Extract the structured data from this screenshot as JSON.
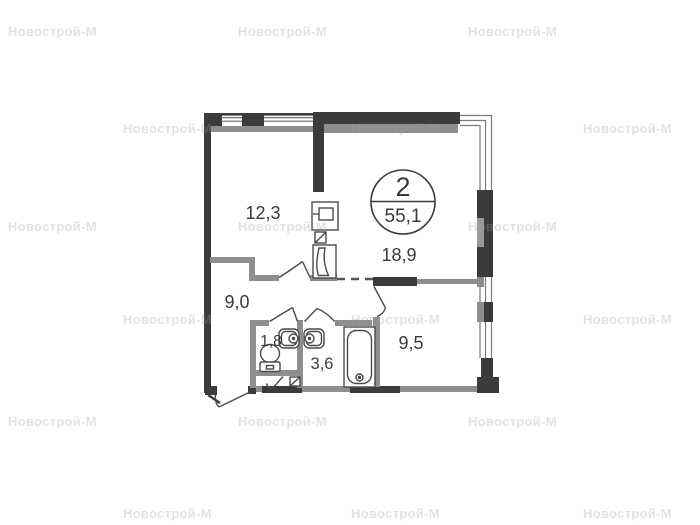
{
  "watermark": {
    "text": "Новострой-М"
  },
  "badge": {
    "rooms_count": "2",
    "total_area": "55,1"
  },
  "rooms": {
    "room1": {
      "label": "12,3"
    },
    "living": {
      "label": "18,9"
    },
    "hall": {
      "label": "9,0"
    },
    "wc": {
      "label": "1,8"
    },
    "bath": {
      "label": "3,6"
    },
    "bedroom": {
      "label": "9,5"
    }
  },
  "colors": {
    "wall_dark": "#3b3b39",
    "wall_gray": "#8e8e8c",
    "line": "#4a4a48",
    "glazing": "#7a7a78",
    "label_text": "#3a3a3a"
  }
}
